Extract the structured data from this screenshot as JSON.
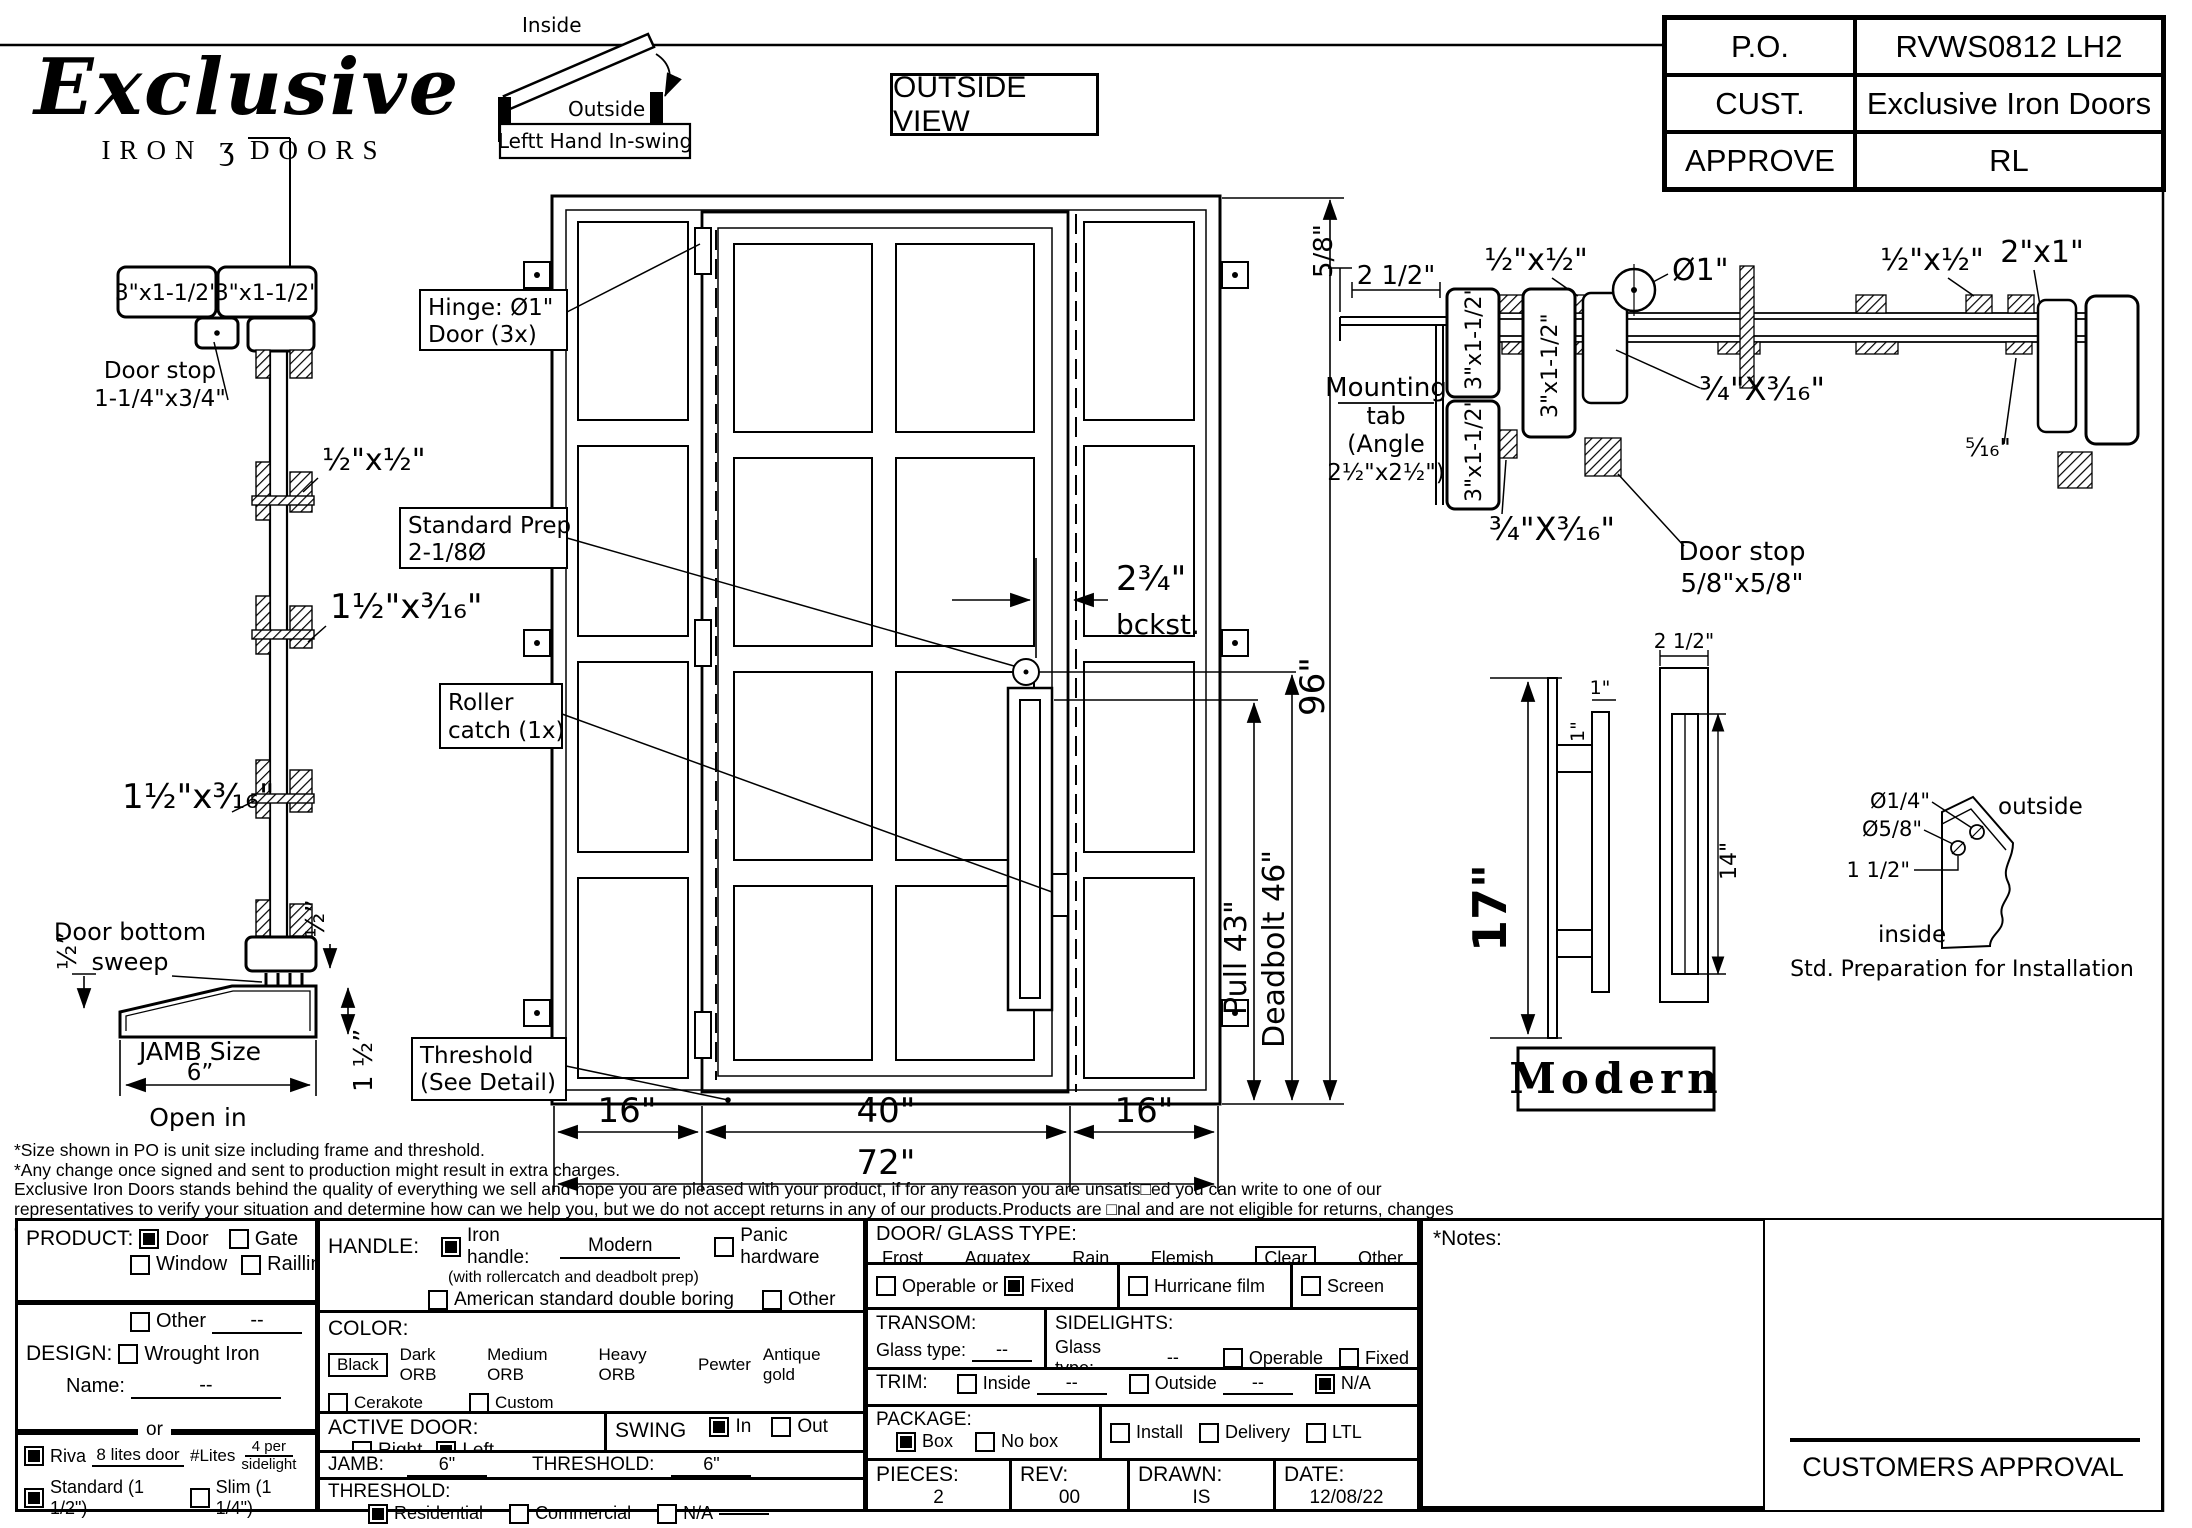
{
  "header": {
    "logo": {
      "script": "Exclusive",
      "iron": "IRON",
      "scroll": "ʒ",
      "doors": "DOORS"
    },
    "swing": {
      "inside": "Inside",
      "outside": "Outside",
      "caption": "Leftt Hand In-swing"
    },
    "view_label": "OUTSIDE VIEW",
    "po_table": {
      "rows": [
        {
          "label": "P.O.",
          "value": "RVWS0812 LH2"
        },
        {
          "label": "CUST.",
          "value": "Exclusive Iron Doors"
        },
        {
          "label": "APPROVE",
          "value": "RL"
        }
      ]
    }
  },
  "left_detail": {
    "head_box_a": "3\"x1-1/2\"",
    "head_box_b": "3\"x1-1/2\"",
    "door_stop_1": "Door stop",
    "door_stop_2": "1-1/4\"x3/4\"",
    "dim_half_half": "½\"x½\"",
    "dim_1half_a": "1½\"x³⁄₁₆\"",
    "dim_1half_b": "1½\"x³⁄₁₆\"",
    "sweep_1": "Door bottom",
    "sweep_2": "sweep",
    "half_left": "½”",
    "half_right": "½”",
    "one_half_right": "1 ½”",
    "jamb_size": "JAMB Size",
    "jamb_size_value": "6”",
    "open_in": "Open in"
  },
  "elevation": {
    "callout_hinge_1": "Hinge: Ø1\"",
    "callout_hinge_2": "Door (3x)",
    "callout_prep_1": "Standard Prep",
    "callout_prep_2": "2-1/8Ø",
    "callout_roller_1": "Roller",
    "callout_roller_2": "catch (1x)",
    "callout_threshold_1": "Threshold",
    "callout_threshold_2": "(See Detail)",
    "bckst_1": "2¾\"",
    "bckst_2": "bckst.",
    "dim_left": "16\"",
    "dim_mid": "40\"",
    "dim_right": "16\"",
    "dim_total": "72\"",
    "dim_pull": "Pull 43\"",
    "dim_deadbolt": "Deadbolt 46\"",
    "dim_height": "96\""
  },
  "plan": {
    "five_eighths": "5/8\"",
    "two_half": "2 1/2\"",
    "mounting_1": "Mounting",
    "mounting_2": "tab",
    "mounting_3": "(Angle",
    "mounting_4": "2½\"x2½\")",
    "jamb_box_a": "3\"x1-1/2\"",
    "jamb_box_b": "3\"x1-1/2\"",
    "jamb_box_c": "3\"x1-1/2\"",
    "half_half_a": "½\"x½\"",
    "half_half_b": "½\"x½\"",
    "dia_one": "Ø1\"",
    "two_by_one": "2\"x1\"",
    "three_quarter_a": "¾\"X³⁄₁₆\"",
    "three_quarter_b": "¾\"X³⁄₁₆\"",
    "five_sixteenths": "⁵⁄₁₆\"",
    "door_stop_1": "Door stop",
    "door_stop_2": "5/8\"x5/8\""
  },
  "pull_detail": {
    "seventeen": "17\"",
    "one_a": "1\"",
    "one_b": "1\"",
    "two_half": "2 1/2\"",
    "fourteen": "14\"",
    "style_label": "Modern"
  },
  "prep_detail": {
    "dia_quarter": "Ø1/4\"",
    "dia_five_eighth": "Ø5/8\"",
    "one_half": "1 1/2\"",
    "outside": "outside",
    "inside": "inside",
    "caption": "Std. Preparation for Installation"
  },
  "footnotes": {
    "lines": [
      "*Size shown in PO is unit size including frame and threshold.",
      "*Any change once signed and sent to production might result in extra charges.",
      "Exclusive Iron Doors stands behind the quality of everything we sell and hope you are pleased with your product, if for any reason you are unsatis□ed you can write to one of our",
      "representatives to verify your situation and determine how can we help you, but we do not accept returns in any of our products.Products are □nal and are not eligible for returns, changes",
      "or alterations.By signing you agree to our terms and conditions, delivery pdf and forms of payment. *Doors measurements do not include the gaps between jambs"
    ]
  },
  "form": {
    "product": {
      "label": "PRODUCT:",
      "door": "Door",
      "gate": "Gate",
      "window": "Window",
      "railing": "Railling",
      "other": "Other",
      "other_value": "--"
    },
    "design": {
      "label": "DESIGN:",
      "wrought": "Wrought Iron",
      "name_label": "Name:",
      "name_value": "--",
      "or": "or"
    },
    "lites": {
      "riva": "Riva",
      "riva_value": "8 lites door",
      "lites_label": "#Lites",
      "lites_value_1": "4 per",
      "lites_value_2": "sidelight",
      "standard": "Standard (1 1/2\")",
      "slim": "Slim (1 1/4\")"
    },
    "handle": {
      "label": "HANDLE:",
      "iron": "Iron handle:",
      "iron_value": "Modern",
      "iron_note": "(with rollercatch and deadbolt prep)",
      "american": "American standard double boring",
      "panic": "Panic hardware",
      "other": "Other"
    },
    "color": {
      "label": "COLOR:",
      "black": "Black",
      "opt1": "Dark ORB",
      "opt2": "Medium ORB",
      "opt3": "Heavy ORB",
      "opt4": "Pewter",
      "opt5": "Antique gold",
      "cerakote": "Cerakote",
      "custom": "Custom"
    },
    "active": {
      "label": "ACTIVE DOOR:",
      "right": "Right",
      "left": "Left"
    },
    "swing": {
      "label": "SWING",
      "in": "In",
      "out": "Out"
    },
    "jamb": {
      "label": "JAMB:",
      "value": "6\"",
      "threshold_label": "THRESHOLD:",
      "threshold_value": "6\""
    },
    "threshold": {
      "label": "THRESHOLD:",
      "residential": "Residential",
      "commercial": "Commercial",
      "na": "N/A"
    },
    "glass": {
      "label": "DOOR/ GLASS TYPE:",
      "frost": "Frost",
      "aquatex": "Aquatex",
      "rain": "Rain",
      "flemish": "Flemish",
      "clear": "Clear",
      "other": "Other"
    },
    "operable_row": {
      "operable": "Operable",
      "or": "or",
      "fixed": "Fixed",
      "hurricane": "Hurricane film",
      "screen": "Screen"
    },
    "transom": {
      "label": "TRANSOM:",
      "glass_type": "Glass type:",
      "value": "--"
    },
    "sidelights": {
      "label": "SIDELIGHTS:",
      "glass_type": "Glass type:",
      "value": "--",
      "operable": "Operable",
      "fixed": "Fixed"
    },
    "trim": {
      "label": "TRIM:",
      "inside": "Inside",
      "inside_value": "--",
      "outside": "Outside",
      "outside_value": "--",
      "na": "N/A"
    },
    "package": {
      "label": "PACKAGE:",
      "box": "Box",
      "nobox": "No box",
      "install": "Install",
      "delivery": "Delivery",
      "ltl": "LTL"
    },
    "pieces": {
      "label": "PIECES:",
      "value": "2"
    },
    "rev": {
      "label": "REV:",
      "value": "00"
    },
    "drawn": {
      "label": "DRAWN:",
      "value": "IS"
    },
    "date": {
      "label": "DATE:",
      "value": "12/08/22"
    },
    "notes_label": "*Notes:",
    "approval_label": "CUSTOMERS APPROVAL"
  }
}
